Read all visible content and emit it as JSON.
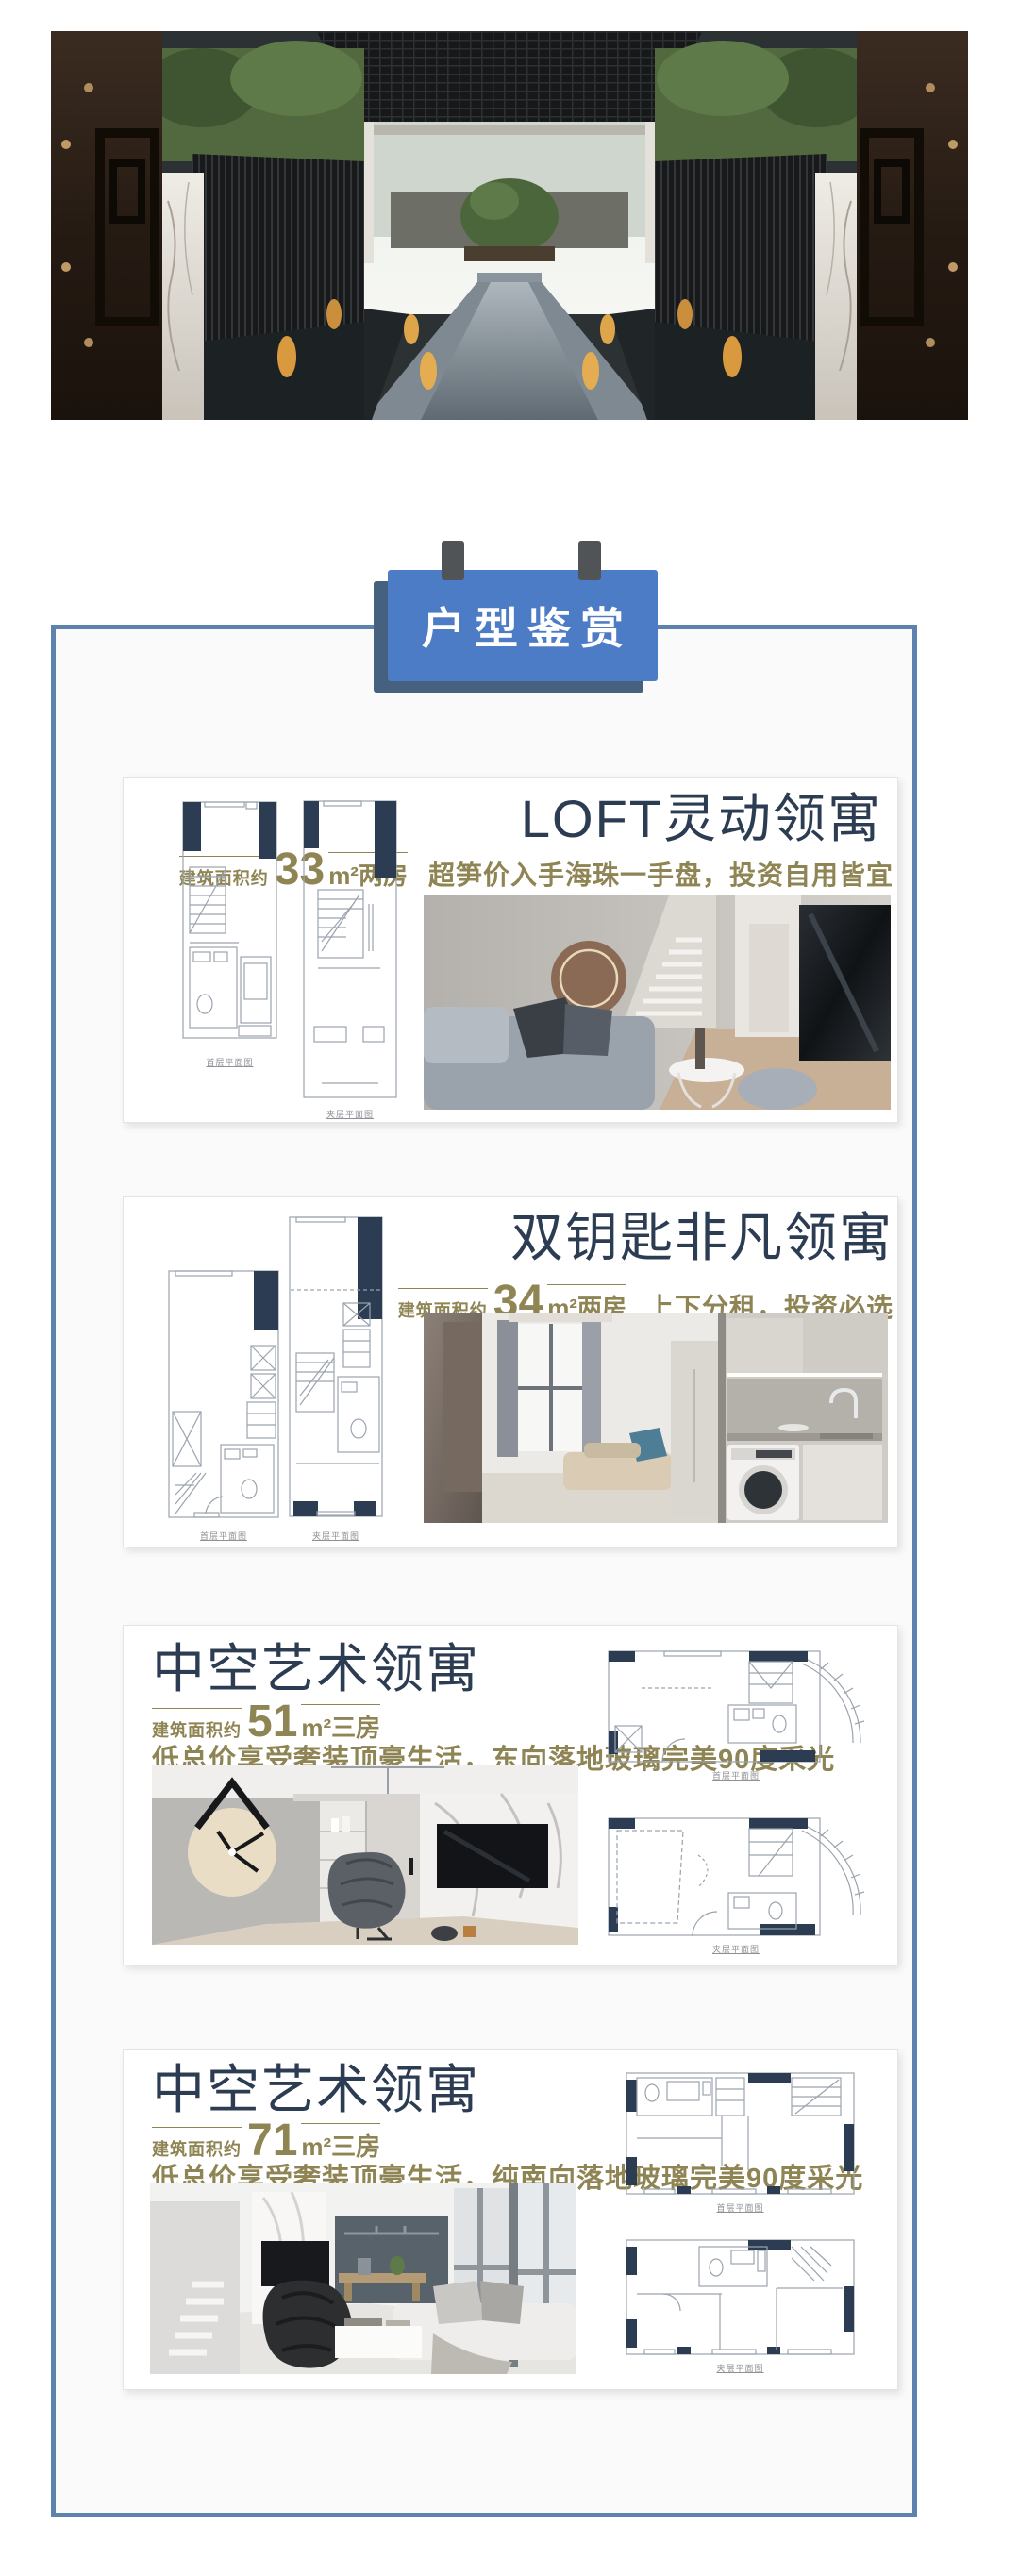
{
  "banner": {
    "label": "户型鉴赏"
  },
  "colors": {
    "banner_blue": "#4d7cc6",
    "banner_shadow": "#46607f",
    "frame_blue": "#5e82b0",
    "title_navy": "#2c3c52",
    "gold": "#8f8454",
    "plan_navy": "#2b3c53"
  },
  "cards": [
    {
      "title": "LOFT灵动领寓",
      "area_label": "建筑面积约",
      "area_value": "33",
      "area_unit": "m²",
      "rooms": "两房",
      "tagline": "超笋价入手海珠一手盘，投资自用皆宜",
      "plan_captions": [
        "首层平面图",
        "夹层平面图"
      ]
    },
    {
      "title": "双钥匙非凡领寓",
      "area_label": "建筑面积约",
      "area_value": "34",
      "area_unit": "m²",
      "rooms": "两房",
      "tagline": "上下分租，投资必选",
      "plan_captions": [
        "首层平面图",
        "夹层平面图"
      ]
    },
    {
      "title": "中空艺术领寓",
      "area_label": "建筑面积约",
      "area_value": "51",
      "area_unit": "m²",
      "rooms": "三房",
      "tagline": "低总价享受奢装顶豪生活，东向落地玻璃完美90度采光",
      "plan_captions": [
        "首层平面图",
        "夹层平面图"
      ]
    },
    {
      "title": "中空艺术领寓",
      "area_label": "建筑面积约",
      "area_value": "71",
      "area_unit": "m²",
      "rooms": "三房",
      "tagline": "低总价享受奢装顶豪生活，纯南向落地玻璃完美90度采光",
      "plan_captions": [
        "首层平面图",
        "夹层平面图"
      ]
    }
  ]
}
